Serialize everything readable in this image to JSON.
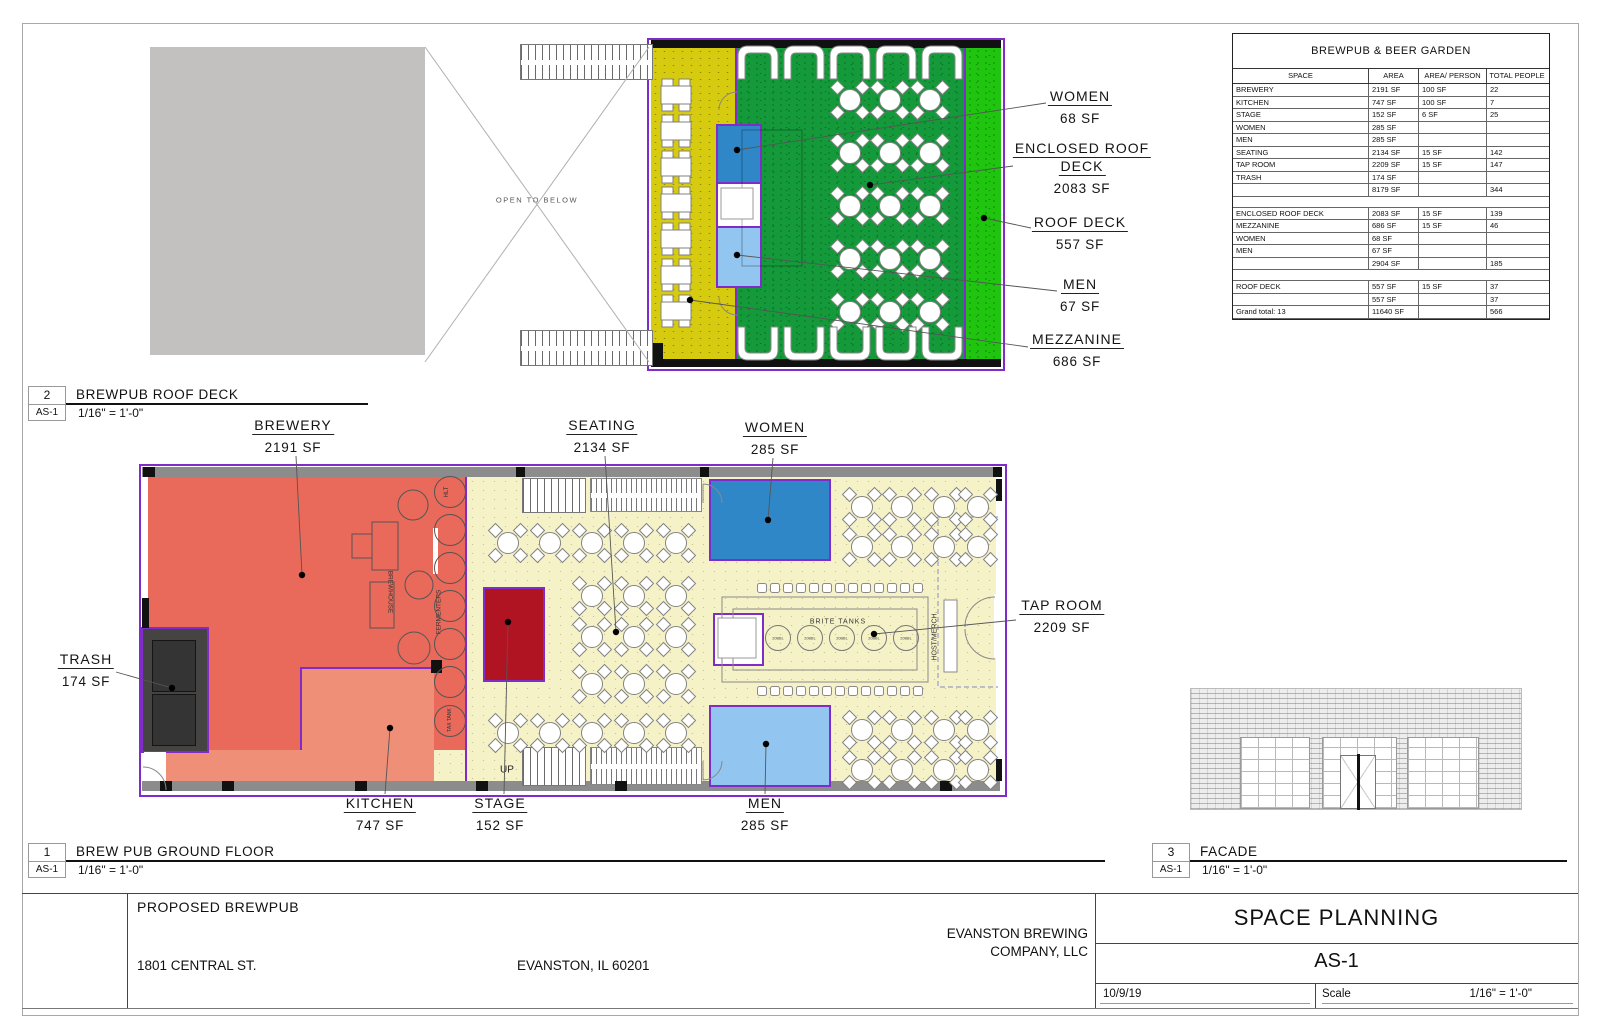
{
  "sheet": {
    "colors": {
      "purple": "#7f2ccb",
      "mezzanine_yellow": "#d7cb0f",
      "enclosed_deck_green": "#149a3a",
      "roof_deck_green": "#1fc50f",
      "women_blue": "#2f87c8",
      "men_blue": "#92c5ef",
      "brewery_red": "#e9695a",
      "kitchen_salmon": "#ef8f77",
      "stage_red": "#b01422",
      "cream": "#f6f2c8",
      "trash_gray": "#454443",
      "wall_gray": "#8c8c8c",
      "roof_gray": "#c2c1c0"
    }
  },
  "area_table": {
    "title": "BREWPUB & BEER GARDEN",
    "columns": [
      "SPACE",
      "AREA",
      "AREA/ PERSON",
      "TOTAL PEOPLE"
    ],
    "rows": [
      {
        "type": "data",
        "space": "BREWERY",
        "area": "2191 SF",
        "per": "100 SF",
        "people": "22"
      },
      {
        "type": "data",
        "space": "KITCHEN",
        "area": "747 SF",
        "per": "100 SF",
        "people": "7"
      },
      {
        "type": "data",
        "space": "STAGE",
        "area": "152 SF",
        "per": "6 SF",
        "people": "25"
      },
      {
        "type": "data",
        "space": "WOMEN",
        "area": "285 SF",
        "per": "",
        "people": ""
      },
      {
        "type": "data",
        "space": "MEN",
        "area": "285 SF",
        "per": "",
        "people": ""
      },
      {
        "type": "data",
        "space": "SEATING",
        "area": "2134 SF",
        "per": "15 SF",
        "people": "142"
      },
      {
        "type": "data",
        "space": "TAP ROOM",
        "area": "2209 SF",
        "per": "15 SF",
        "people": "147"
      },
      {
        "type": "data",
        "space": "TRASH",
        "area": "174 SF",
        "per": "",
        "people": ""
      },
      {
        "type": "subtotal",
        "space": "",
        "area": "8179 SF",
        "per": "",
        "people": "344"
      },
      {
        "type": "gap"
      },
      {
        "type": "data",
        "space": "ENCLOSED ROOF DECK",
        "area": "2083 SF",
        "per": "15 SF",
        "people": "139"
      },
      {
        "type": "data",
        "space": "MEZZANINE",
        "area": "686 SF",
        "per": "15 SF",
        "people": "46"
      },
      {
        "type": "data",
        "space": "WOMEN",
        "area": "68 SF",
        "per": "",
        "people": ""
      },
      {
        "type": "data",
        "space": "MEN",
        "area": "67 SF",
        "per": "",
        "people": ""
      },
      {
        "type": "subtotal",
        "space": "",
        "area": "2904 SF",
        "per": "",
        "people": "185"
      },
      {
        "type": "gap"
      },
      {
        "type": "data",
        "space": "ROOF DECK",
        "area": "557 SF",
        "per": "15 SF",
        "people": "37"
      },
      {
        "type": "subtotal",
        "space": "",
        "area": "557 SF",
        "per": "",
        "people": "37"
      },
      {
        "type": "total",
        "space": "Grand total: 13",
        "area": "11640 SF",
        "per": "",
        "people": "566"
      }
    ]
  },
  "roof_plan": {
    "open_to_below": "OPEN TO BELOW",
    "callouts": [
      {
        "lines": [
          "WOMEN"
        ],
        "value": "68 SF",
        "cx": 1080,
        "ty": 88,
        "ax": 1046,
        "ay": 103,
        "dx": 737,
        "dy": 150
      },
      {
        "lines": [
          "ENCLOSED ROOF",
          "DECK"
        ],
        "value": "2083 SF",
        "cx": 1082,
        "ty": 140,
        "ax": 1013,
        "ay": 166,
        "dx": 870,
        "dy": 185
      },
      {
        "lines": [
          "ROOF DECK"
        ],
        "value": "557 SF",
        "cx": 1080,
        "ty": 214,
        "ax": 1031,
        "ay": 228,
        "dx": 984,
        "dy": 218
      },
      {
        "lines": [
          "MEN"
        ],
        "value": "67 SF",
        "cx": 1080,
        "ty": 276,
        "ax": 1057,
        "ay": 291,
        "dx": 737,
        "dy": 255
      },
      {
        "lines": [
          "MEZZANINE"
        ],
        "value": "686 SF",
        "cx": 1077,
        "ty": 331,
        "ax": 1028,
        "ay": 347,
        "dx": 690,
        "dy": 300
      }
    ]
  },
  "ground_plan": {
    "up": "UP",
    "brewhouse": "BREWHOUSE",
    "fermenters": "FERMENTERS",
    "hlt": "HLT",
    "tax_tank": "TAX TANK",
    "brite_tanks": "BRITE TANKS",
    "tank_size": "20BBL",
    "host_merch": "HOST/MERCH.",
    "callouts": [
      {
        "lines": [
          "BREWERY"
        ],
        "value": "2191 SF",
        "cx": 293,
        "ty": 417,
        "ax": 296,
        "ay": 456,
        "dx": 302,
        "dy": 575
      },
      {
        "lines": [
          "SEATING"
        ],
        "value": "2134 SF",
        "cx": 602,
        "ty": 417,
        "ax": 605,
        "ay": 456,
        "dx": 616,
        "dy": 632
      },
      {
        "lines": [
          "WOMEN"
        ],
        "value": "285 SF",
        "cx": 775,
        "ty": 419,
        "ax": 773,
        "ay": 458,
        "dx": 768,
        "dy": 520
      },
      {
        "lines": [
          "TRASH"
        ],
        "value": "174 SF",
        "cx": 86,
        "ty": 651,
        "ax": 116,
        "ay": 672,
        "dx": 172,
        "dy": 688
      },
      {
        "lines": [
          "TAP ROOM"
        ],
        "value": "2209 SF",
        "cx": 1062,
        "ty": 597,
        "ax": 1016,
        "ay": 620,
        "dx": 874,
        "dy": 634
      },
      {
        "lines": [
          "KITCHEN"
        ],
        "value": "747 SF",
        "cx": 380,
        "ty": 795,
        "ax": 385,
        "ay": 794,
        "dx": 390,
        "dy": 728
      },
      {
        "lines": [
          "STAGE"
        ],
        "value": "152 SF",
        "cx": 500,
        "ty": 795,
        "ax": 504,
        "ay": 794,
        "dx": 508,
        "dy": 622
      },
      {
        "lines": [
          "MEN"
        ],
        "value": "285 SF",
        "cx": 765,
        "ty": 795,
        "ax": 765,
        "ay": 794,
        "dx": 766,
        "dy": 744
      }
    ]
  },
  "tags": {
    "roof_deck": {
      "num": "2",
      "sheet": "AS-1",
      "title": "BREWPUB ROOF DECK",
      "scale": "1/16\" = 1'-0\""
    },
    "ground_floor": {
      "num": "1",
      "sheet": "AS-1",
      "title": "BREW PUB GROUND FLOOR",
      "scale": "1/16\" = 1'-0\""
    },
    "facade": {
      "num": "3",
      "sheet": "AS-1",
      "title": "FACADE",
      "scale": "1/16\" = 1'-0\""
    }
  },
  "titleblock": {
    "project": "PROPOSED BREWPUB",
    "address": "1801 CENTRAL ST.",
    "city": "EVANSTON, IL 60201",
    "company_line1": "EVANSTON BREWING",
    "company_line2": "COMPANY, LLC",
    "sheet_title": "SPACE PLANNING",
    "sheet_number": "AS-1",
    "date": "10/9/19",
    "scale_label": "Scale",
    "scale_value": "1/16\" = 1'-0\""
  }
}
